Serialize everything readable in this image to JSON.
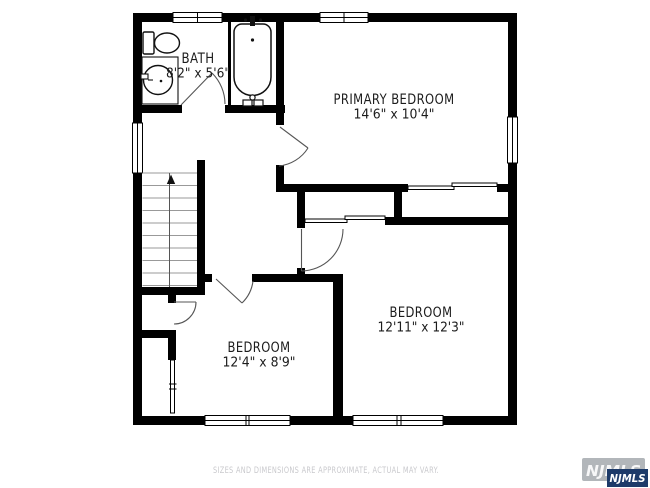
{
  "plan": {
    "bath": {
      "name": "BATH",
      "dims": "8'2\" x 5'6\""
    },
    "primary": {
      "name": "PRIMARY BEDROOM",
      "dims": "14'6\" x 10'4\""
    },
    "bedroom_right": {
      "name": "BEDROOM",
      "dims": "12'11\" x 12'3\""
    },
    "bedroom_lower": {
      "name": "BEDROOM",
      "dims": "12'4\" x 8'9\""
    },
    "stairs": {
      "direction": "up"
    }
  },
  "footer": {
    "disclaimer": "SIZES AND DIMENSIONS ARE APPROXIMATE, ACTUAL MAY VARY."
  },
  "watermark": {
    "label_front": "NJMLS",
    "label_back": "NJMLS",
    "navy": "#1d3a69",
    "gray": "#b2b6ba"
  },
  "colors": {
    "wall": "#000000",
    "door_swing": "#555555",
    "stair_tread": "#999999",
    "label_text": "#1c1c1c",
    "footer_text": "#c9c9cd",
    "background": "#ffffff"
  }
}
